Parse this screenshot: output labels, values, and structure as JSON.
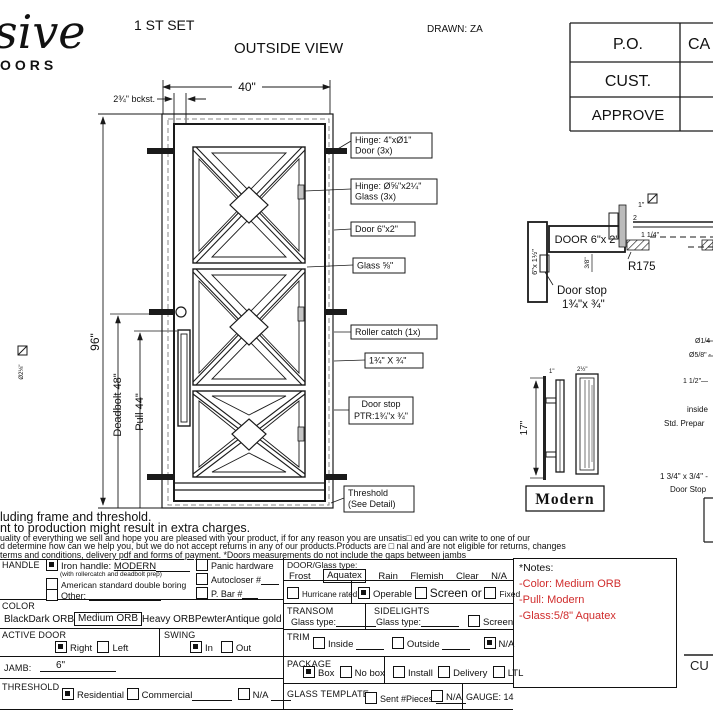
{
  "header": {
    "logo": {
      "script": "sive",
      "sub": "OORS"
    },
    "set_label": "1 ST SET",
    "view_title": "OUTSIDE VIEW",
    "drawn_by": "DRAWN: ZA",
    "approval": {
      "rows": [
        {
          "label": "P.O.",
          "value": "CA"
        },
        {
          "label": "CUST.",
          "value": ""
        },
        {
          "label": "APPROVE",
          "value": ""
        }
      ]
    }
  },
  "drawing": {
    "dims": {
      "width": "40\"",
      "backset": "2¾\" bckst.",
      "height": "96\"",
      "deadbolt": "Deadbolt 48\"",
      "pull": "Pull 44\"",
      "bore": "Ø2⅛\""
    },
    "callouts": {
      "hinge_door_1": "Hinge: 4\"xØ1\"",
      "hinge_door_2": "Door (3x)",
      "hinge_glass_1": "Hinge: Ø⅝\"x2¼\"",
      "hinge_glass_2": "Glass (3x)",
      "door": "Door 6\"x2\"",
      "glass": "Glass ⅝\"",
      "roller": "Roller catch  (1x)",
      "stop_size": "1¾\" X ¾\"",
      "door_stop_1": "Door stop",
      "door_stop_2": "PTR:1¾\"x ¾\"",
      "threshold_1": "Threshold",
      "threshold_2": "(See Detail)"
    },
    "section": {
      "door": "DOOR 6\"x 2\"",
      "jamb": "6\"x 1½\"",
      "r": "R175",
      "d38": "3/8\"",
      "d1": "1\"",
      "d2": "2",
      "d114": "1 1/4\"",
      "stop1": "Door stop",
      "stop2": "1¾\"x ¾\""
    },
    "edge": {
      "e1": "Ø1/4",
      "e2": "Ø5/8\" -",
      "e3": "1 1/2\"—",
      "e4": "inside",
      "e5": "Std. Prepar",
      "e6": "1 3/4\" x 3/4\" -",
      "e7": "Door Stop"
    },
    "handle": {
      "h17": "17\"",
      "h1": "1\"",
      "h25": "2½\"",
      "name": "Modern"
    }
  },
  "disclaimer": {
    "l1": "luding frame and threshold.",
    "l2": "nt to production might result in extra charges.",
    "l3": "uality of everything we sell and hope you are pleased with your product, if for any reason you are unsatis□ ed you can write to one of our",
    "l4": "d determine how can we help you, but we do not accept returns in any of our products.Products are □ nal and are not eligible for returns, changes",
    "l5": "terms and conditions, delivery pdf and forms of payment. *Doors measurements do not include the gaps between jambs"
  },
  "form": {
    "handle": {
      "label": "HANDLE",
      "iron_a": "Iron handle:",
      "iron_b": "MODERN",
      "iron_sub": "(with rollercatch and deadbolt prep)",
      "american": "American standard double boring",
      "other": "Other:",
      "panic": "Panic hardware",
      "autocloser": "Autocloser #",
      "pbar": "P. Bar #"
    },
    "color": {
      "label": "COLOR",
      "opts": [
        "Black",
        "Dark ORB",
        "Medium ORB",
        "Heavy ORB",
        "Pewter",
        "Antique gold"
      ],
      "selected": "Medium ORB"
    },
    "active_door": {
      "label": "ACTIVE DOOR",
      "right": "Right",
      "left": "Left"
    },
    "swing": {
      "label": "SWING",
      "in": "In",
      "out": "Out"
    },
    "jamb": {
      "label": "JAMB:",
      "value": "6\""
    },
    "threshold": {
      "label": "THRESHOLD",
      "residential": "Residential",
      "commercial": "Commercial",
      "na": "N/A"
    },
    "door_glass": {
      "label": "DOOR/Glass type:",
      "opts": [
        "Frost",
        "Aquatex",
        "Rain",
        "Flemish",
        "Clear",
        "N/A"
      ],
      "selected": "Aquatex"
    },
    "hurricane": "Hurricane rated",
    "operable": "Operable",
    "screen_or": "Screen or",
    "fixed": "Fixed",
    "transom": {
      "label": "TRANSOM",
      "glass_type": "Glass type:"
    },
    "sidelights": {
      "label": "SIDELIGHTS",
      "glass_type": "Glass type:",
      "screen": "Screen"
    },
    "trim": {
      "label": "TRIM",
      "inside": "Inside",
      "outside": "Outside",
      "na": "N/A"
    },
    "package": {
      "label": "PACKAGE",
      "box": "Box",
      "no_box": "No box",
      "install": "Install",
      "delivery": "Delivery",
      "ltl": "LTL"
    },
    "glass_template": {
      "label": "GLASS TEMPLATE",
      "sent": "Sent #Pieces:",
      "na": "N/A",
      "gauge": "GAUGE: 14"
    },
    "notes": {
      "title": "*Notes:",
      "lines": [
        "-Color: Medium ORB",
        "-Pull: Modern",
        "-Glass:5/8\"  Aquatex"
      ],
      "accent": "#d02c2c"
    },
    "signature": "CU"
  }
}
